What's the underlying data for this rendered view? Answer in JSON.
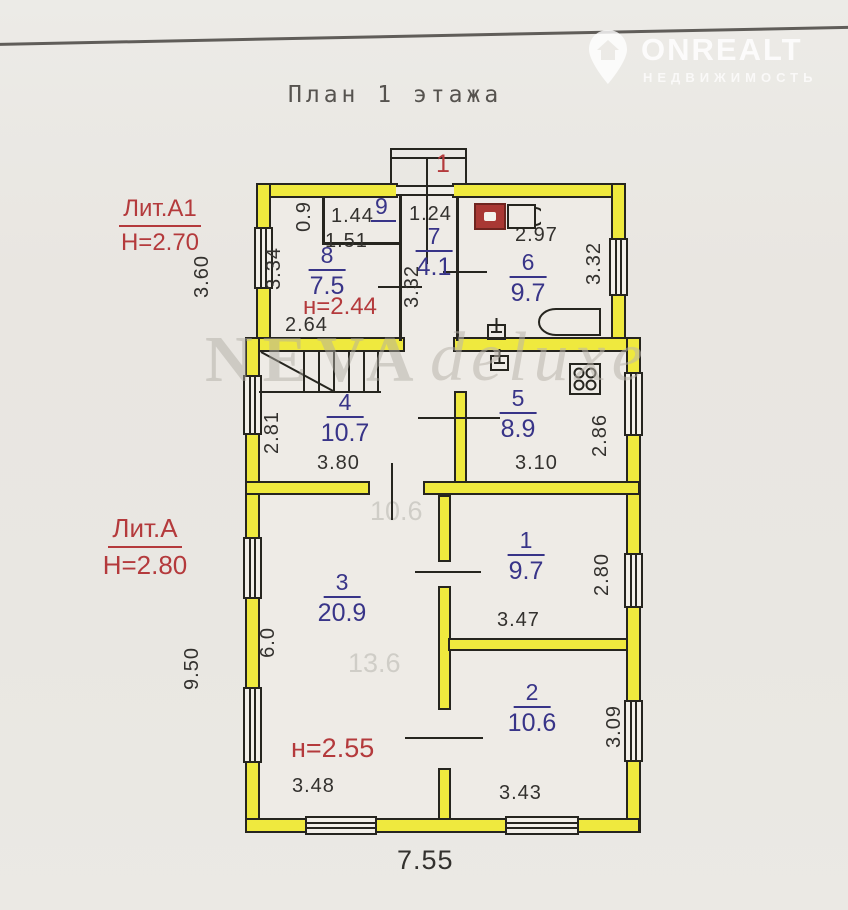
{
  "page": {
    "title": "План 1 этажа"
  },
  "logo": {
    "brand": "ONREALT",
    "subtitle": "НЕДВИЖИМОСТЬ"
  },
  "watermark": {
    "word1": "NEVA",
    "word2": "deluxe"
  },
  "sections": {
    "a1": {
      "label": "Лит.А1",
      "height": "Н=2.70",
      "ceiling_note": "н=2.44"
    },
    "a": {
      "label": "Лит.А",
      "height": "Н=2.80",
      "ceiling_note": "н=2.55"
    }
  },
  "entrance": {
    "number": "1"
  },
  "rooms": {
    "r9": {
      "number": "9"
    },
    "r8": {
      "number": "8",
      "area": "7.5"
    },
    "r7": {
      "number": "7",
      "area": "4.1"
    },
    "r6": {
      "number": "6",
      "area": "9.7"
    },
    "r4": {
      "number": "4",
      "area": "10.7"
    },
    "r5": {
      "number": "5",
      "area": "8.9"
    },
    "r3": {
      "number": "3",
      "area": "20.9"
    },
    "r1": {
      "number": "1",
      "area": "9.7"
    },
    "r2": {
      "number": "2",
      "area": "10.6"
    }
  },
  "dims": {
    "closet_h": "0.9",
    "closet_w": "1.44",
    "closet_w2": "1.51",
    "hall_w": "1.24",
    "room6_w": "2.97",
    "room8_h": "3.34",
    "hall_h": "3.32",
    "room6_h": "3.32",
    "annex_depth": "3.60",
    "room8_w": "2.64",
    "room4_h": "2.81",
    "room4_w": "3.80",
    "room5_h": "2.86",
    "room5_w": "3.10",
    "room3_h": "6.0",
    "room1_h": "2.80",
    "room1_w": "3.47",
    "house_depth": "9.50",
    "room2_h": "3.09",
    "room2_w": "3.43",
    "room3_w": "3.48",
    "house_width": "7.55"
  },
  "ghost_text": {
    "g1": "10.6",
    "g2": "13.6"
  },
  "colors": {
    "wall_fill": "#efe93e",
    "room_number": "#383488",
    "dimension": "#33312e",
    "red_note": "#b43a3c"
  }
}
